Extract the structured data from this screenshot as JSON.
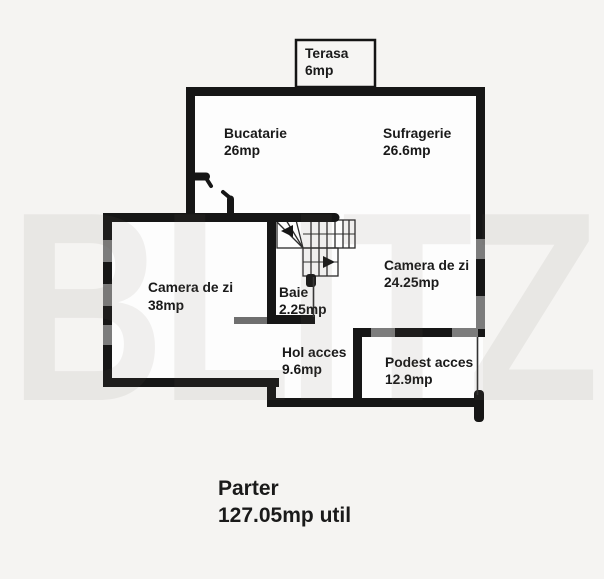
{
  "watermark": "BLITZ",
  "colors": {
    "background": "#f5f4f2",
    "wall": "#161616",
    "window_segment": "#7c7c7c",
    "room_fill": "#fdfdfd",
    "label_text": "#1a1a1a"
  },
  "plan": {
    "rooms": [
      {
        "id": "terasa",
        "name": "Terasa",
        "area": "6mp"
      },
      {
        "id": "bucatarie",
        "name": "Bucatarie",
        "area": "26mp"
      },
      {
        "id": "sufragerie",
        "name": "Sufragerie",
        "area": "26.6mp"
      },
      {
        "id": "camera-de-zi-mare",
        "name": "Camera de zi",
        "area": "38mp"
      },
      {
        "id": "camera-de-zi",
        "name": "Camera de zi",
        "area": "24.25mp"
      },
      {
        "id": "baie",
        "name": "Baie",
        "area": "2.25mp"
      },
      {
        "id": "hol-acces",
        "name": "Hol acces",
        "area": "9.6mp"
      },
      {
        "id": "podest-acces",
        "name": "Podest acces",
        "area": "12.9mp"
      }
    ],
    "title": {
      "floor": "Parter",
      "area": "127.05mp util"
    }
  }
}
